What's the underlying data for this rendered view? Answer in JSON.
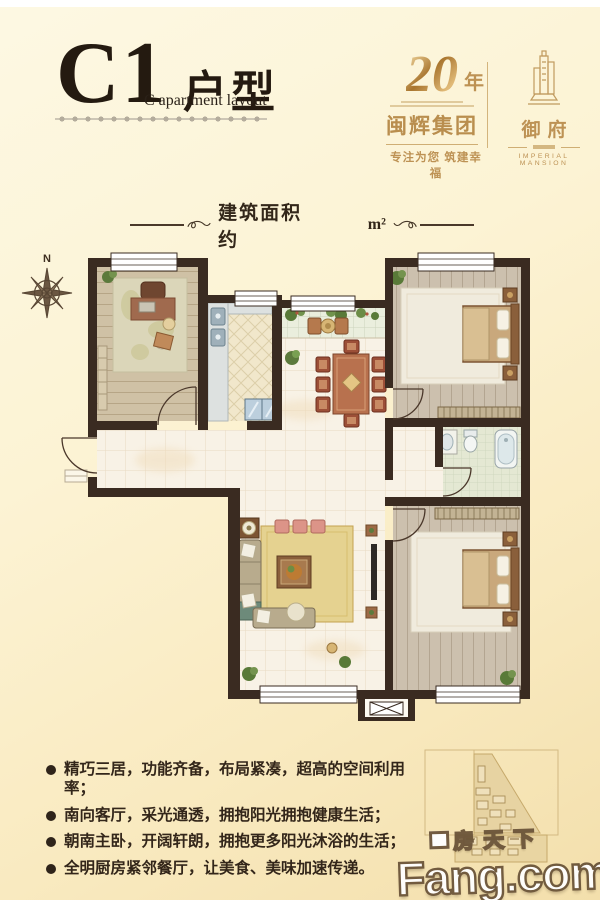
{
  "header": {
    "code": "C1",
    "type_cn": "户型",
    "type_en": "C apartment layout"
  },
  "area_line": {
    "label": "建筑面积约",
    "value": "",
    "unit": "m²"
  },
  "brand": {
    "anniversary_number": "20",
    "anniversary_suffix": "年",
    "group_name": "闽辉集团",
    "slogan": "专注为您 筑建幸福",
    "project_name_cn": "御府",
    "project_name_en": "IMPERIAL MANSION"
  },
  "compass": {
    "north": "N"
  },
  "features": {
    "items": [
      "精巧三居，功能齐备，布局紧凑，超高的空间利用率；",
      "南向客厅，采光通透，拥抱阳光拥抱健康生活；",
      "朝南主卧，开阔轩朗，拥抱更多阳光沐浴的生活；",
      "全明厨房紧邻餐厅，让美食、美味加速传递。"
    ]
  },
  "watermark": {
    "cn": "房天下",
    "en": "Fang.com"
  },
  "colors": {
    "gold": "#bd9254",
    "wall": "#3a2b21",
    "background": "#fbf2d5"
  }
}
